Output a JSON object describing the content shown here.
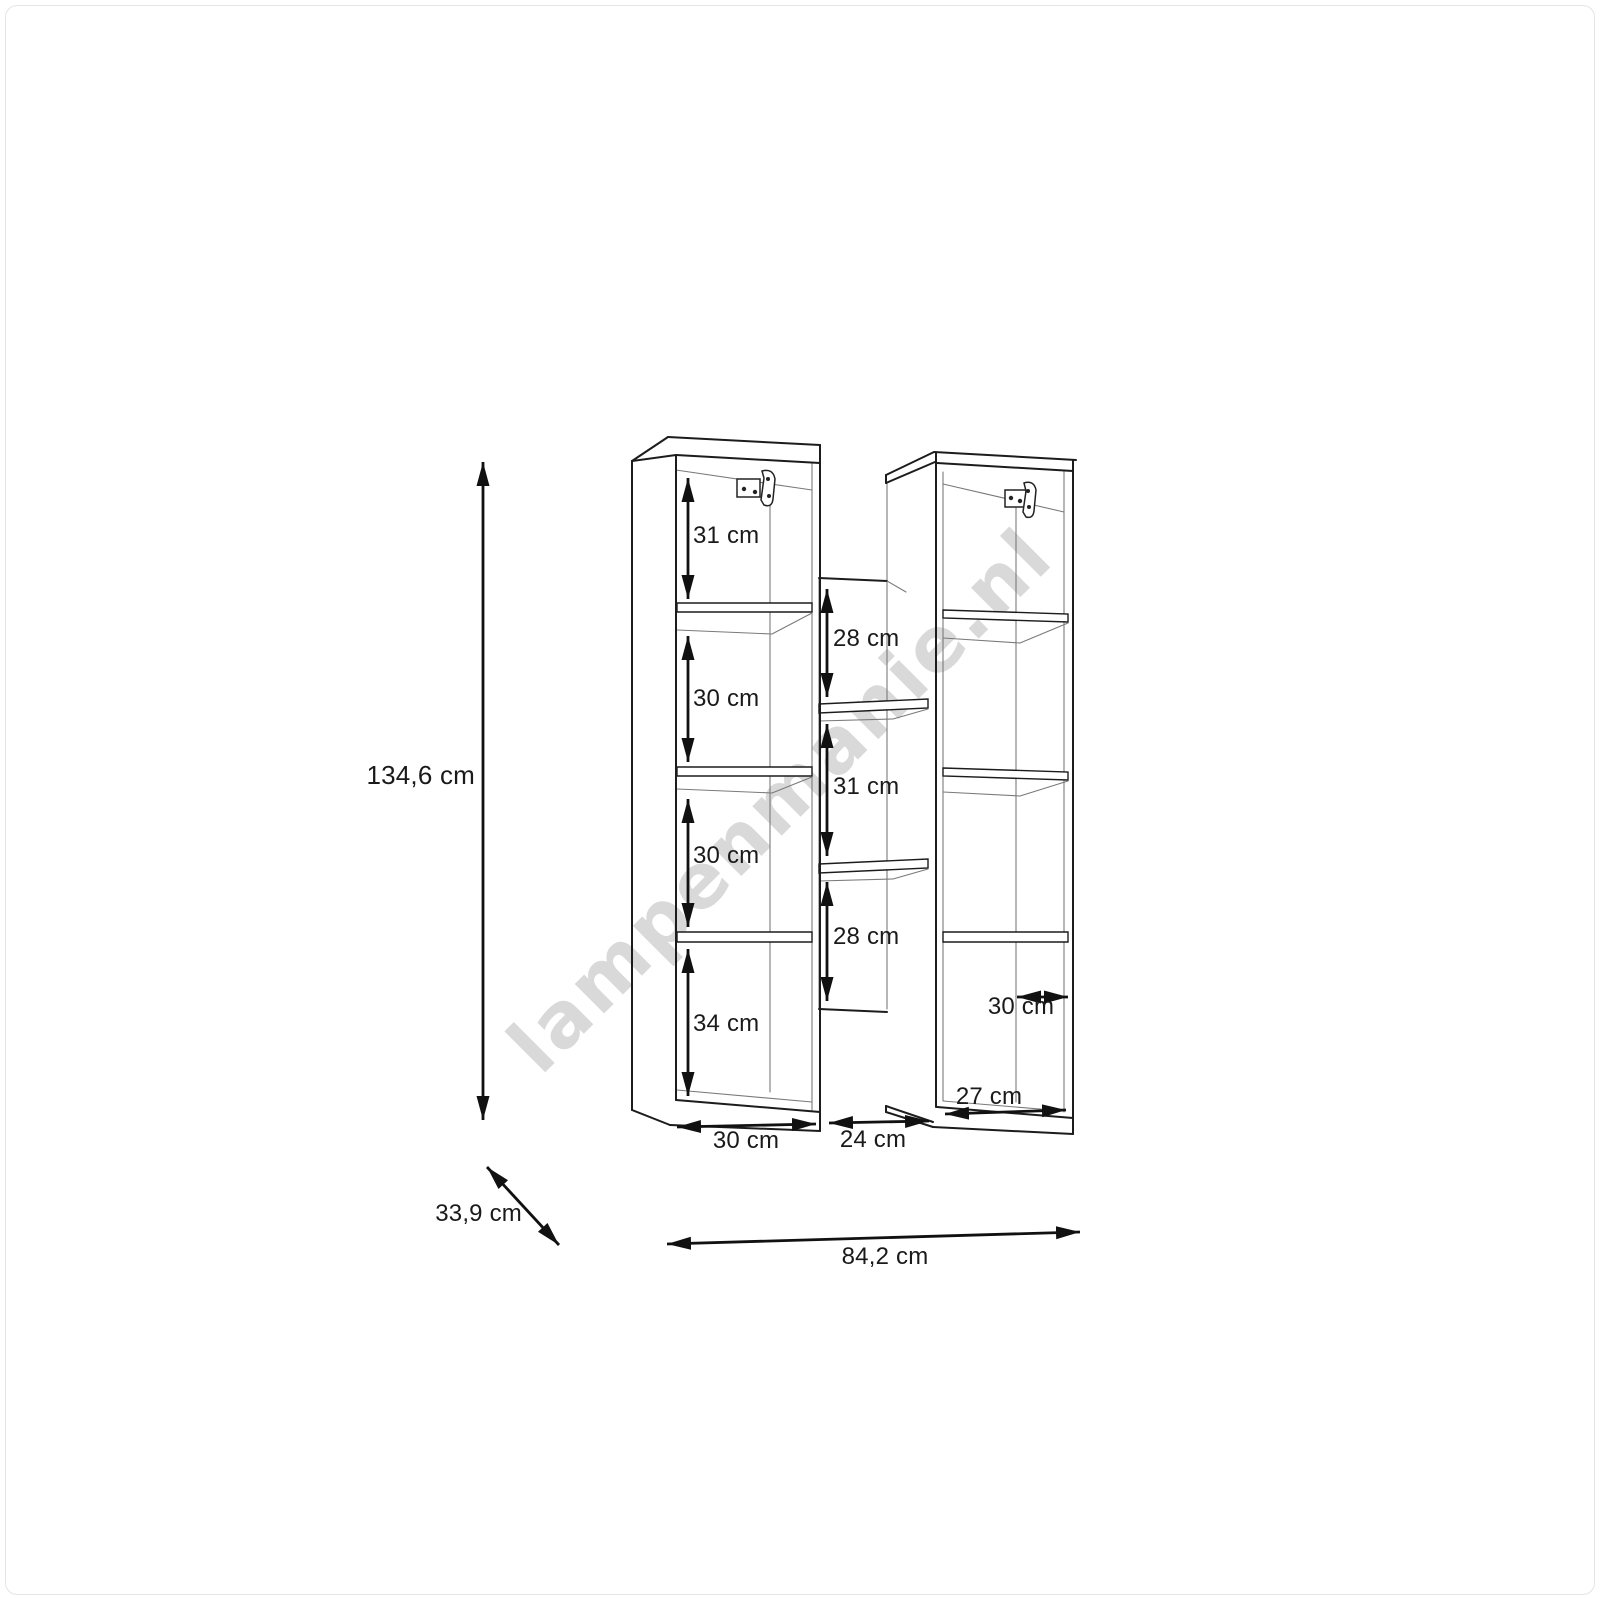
{
  "watermark": "lampenmanie.nl",
  "dimensions": {
    "overall": {
      "height": "134,6 cm",
      "depth": "33,9 cm",
      "width": "84,2 cm"
    },
    "left_column": {
      "compartment_heights": [
        "31 cm",
        "30 cm",
        "30 cm",
        "34 cm"
      ],
      "width": "30 cm"
    },
    "middle_section": {
      "compartment_heights": [
        "28 cm",
        "31 cm",
        "28 cm"
      ],
      "width": "24 cm"
    },
    "right_column": {
      "compartment_width": "30 cm",
      "bottom_depth": "27 cm"
    }
  }
}
